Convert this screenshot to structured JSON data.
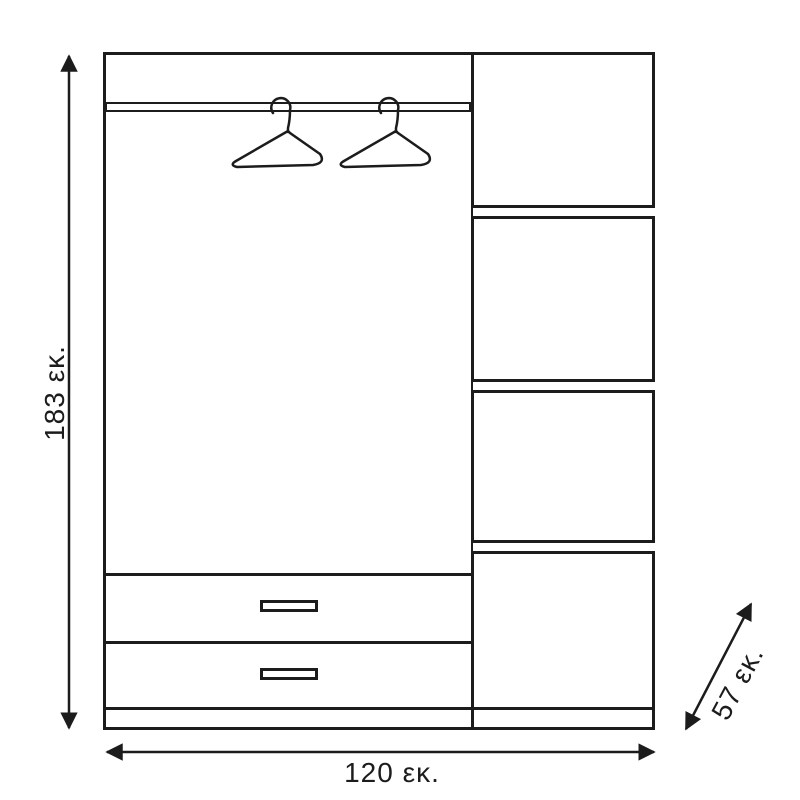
{
  "diagram": {
    "title": "wardrobe-dimension-drawing",
    "colors": {
      "line": "#1c1c1c",
      "background": "#ffffff"
    },
    "dimensions": {
      "height_label": "183 εκ.",
      "width_label": "120 εκ.",
      "depth_label": "57 εκ."
    },
    "wardrobe": {
      "left_section": {
        "hanging_rails": 1,
        "hangers": 2,
        "drawers": 2,
        "drawer_handles": 2
      },
      "right_section": {
        "compartments": 4,
        "shelves": 3
      },
      "plinth": 1
    }
  }
}
